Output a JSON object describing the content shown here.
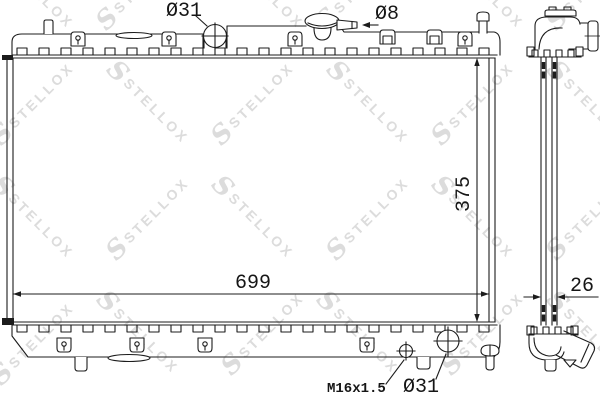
{
  "labels": {
    "filler_neck_diameter": "Ø31",
    "overflow_tube_diameter": "Ø8",
    "core_width": "699",
    "core_height": "375",
    "drain_plug_thread": "M16x1.5",
    "outlet_diameter": "Ø31",
    "core_thickness": "26"
  },
  "watermark": {
    "logo": "S",
    "text": "STELLOX"
  },
  "colors": {
    "line": "#1c1c1c",
    "watermark": "#dcdcdc",
    "background": "#ffffff"
  }
}
